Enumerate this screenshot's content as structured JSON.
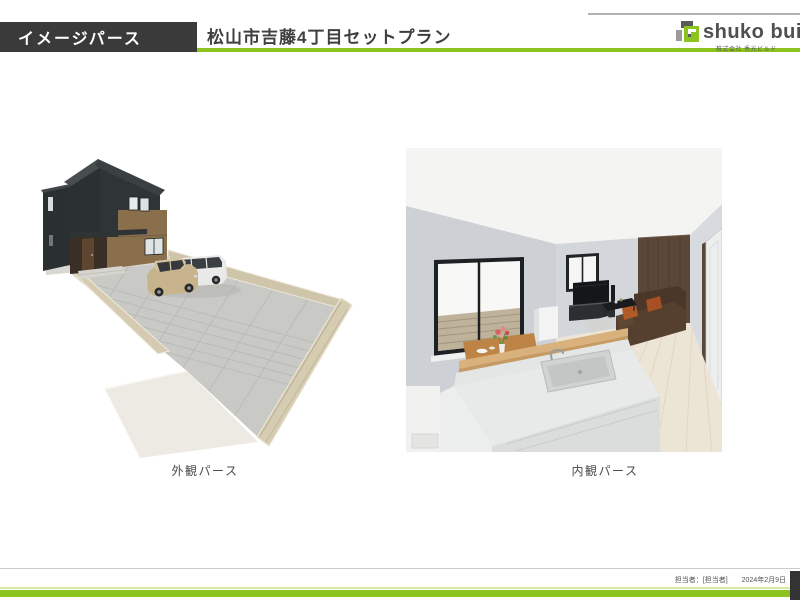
{
  "header": {
    "section_label": "イメージパース",
    "plan_title": "松山市吉藤4丁目セットプラン"
  },
  "logo": {
    "brand_text": "shuko build",
    "company_name": "株式会社 秀光ビルド"
  },
  "renders": {
    "exterior": {
      "caption": "外観パース"
    },
    "interior": {
      "caption": "内観パース"
    }
  },
  "footer": {
    "staff_label": "担当者：[担当者]",
    "date": "2024年2月9日"
  },
  "colors": {
    "accent_green": "#8dc31e",
    "header_dark": "#3a3a3a",
    "logo_gray": "#4f4f4f"
  }
}
